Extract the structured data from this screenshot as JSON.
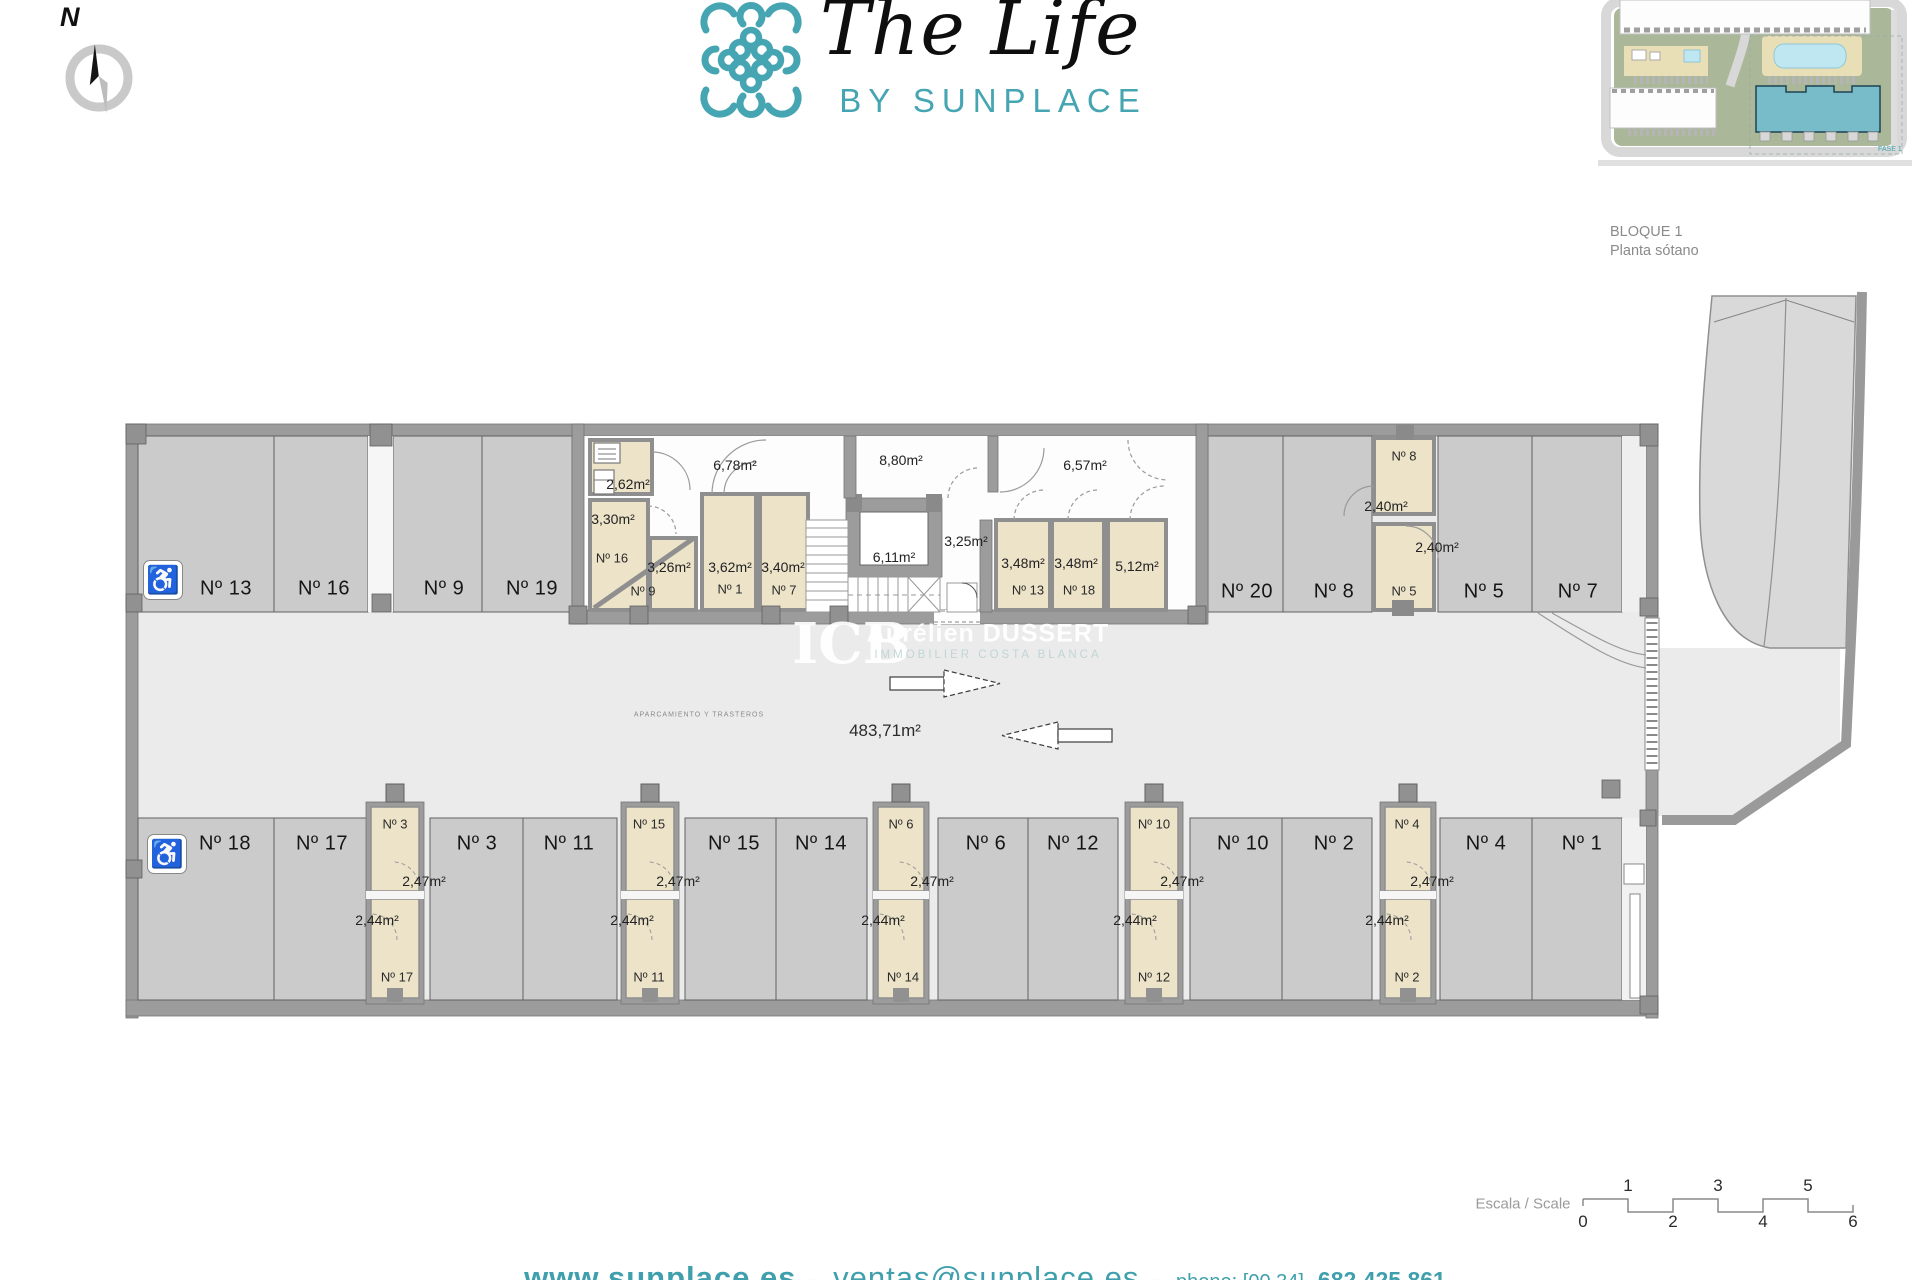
{
  "header": {
    "brand": {
      "title": "The Life",
      "subtitle": "BY SUNPLACE"
    },
    "compass_label": "N",
    "block_title": "BLOQUE 1",
    "block_subtitle": "Planta sótano",
    "sitemap": {
      "fase_label": "FASE 1"
    }
  },
  "colors": {
    "brand_teal": "#46a5b2",
    "footer_teal": "#3f9fac",
    "floor": "#ebebeb",
    "stall_gray": "#cbcbcb",
    "wall_gray": "#9c9c9c",
    "storage_beige": "#ece3c9",
    "sitemap_building_teal": "#78bcc9"
  },
  "plan": {
    "top_parking": [
      "Nº 13",
      "Nº 16",
      "Nº 9",
      "Nº 19",
      "Nº 20",
      "Nº 8",
      "Nº 5",
      "Nº 7"
    ],
    "bottom_parking": [
      "Nº 18",
      "Nº 17",
      "Nº 3",
      "Nº 11",
      "Nº 15",
      "Nº 14",
      "Nº 6",
      "Nº 12",
      "Nº 10",
      "Nº 2",
      "Nº 4",
      "Nº 1"
    ],
    "storage_top": {
      "r262": "2,62m²",
      "r330": "3,30m²",
      "n16": "Nº 16",
      "r326": "3,26m²",
      "n9": "Nº 9",
      "r362": "3,62m²",
      "n1": "Nº 1",
      "r340": "3,40m²",
      "n7": "Nº 7",
      "r348a": "3,48m²",
      "n13": "Nº 13",
      "r348b": "3,48m²",
      "n18": "Nº 18",
      "r512": "5,12m²",
      "r240a": "2,40m²",
      "n8": "Nº 8",
      "r240b": "2,40m²",
      "n5": "Nº 5"
    },
    "corridors": {
      "c678": "6,78m²",
      "c880": "8,80m²",
      "c657": "6,57m²",
      "c611": "6,11m²",
      "c325": "3,25m²"
    },
    "storage_bottom": [
      {
        "num_top": "Nº 3",
        "area_top": "2,47m²",
        "area_bottom": "2,44m²",
        "num_bottom": "Nº 17"
      },
      {
        "num_top": "Nº 15",
        "area_top": "2,47m²",
        "area_bottom": "2,44m²",
        "num_bottom": "Nº 11"
      },
      {
        "num_top": "Nº 6",
        "area_top": "2,47m²",
        "area_bottom": "2,44m²",
        "num_bottom": "Nº 14"
      },
      {
        "num_top": "Nº 10",
        "area_top": "2,47m²",
        "area_bottom": "2,44m²",
        "num_bottom": "Nº 12"
      },
      {
        "num_top": "Nº 4",
        "area_top": "2,47m²",
        "area_bottom": "2,44m²",
        "num_bottom": "Nº 2"
      }
    ],
    "aisle": {
      "zone_label": "APARCAMIENTO Y TRASTEROS",
      "total_area": "483,71m²"
    },
    "accessible_icon": "♿"
  },
  "watermark": {
    "initials": "ICB",
    "name": "Aurélien DUSSERT",
    "tagline": "IMMOBILIER COSTA BLANCA"
  },
  "scalebar": {
    "label": "Escala / Scale",
    "top": [
      "1",
      "3",
      "5"
    ],
    "bottom": [
      "0",
      "2",
      "4",
      "6"
    ]
  },
  "footer": {
    "website": "www.sunplace.es",
    "sep1": "-",
    "email": "ventas@sunplace.es",
    "sep2": "-",
    "phone_label": "phone: [00 34]",
    "phone": "682 425 861"
  }
}
